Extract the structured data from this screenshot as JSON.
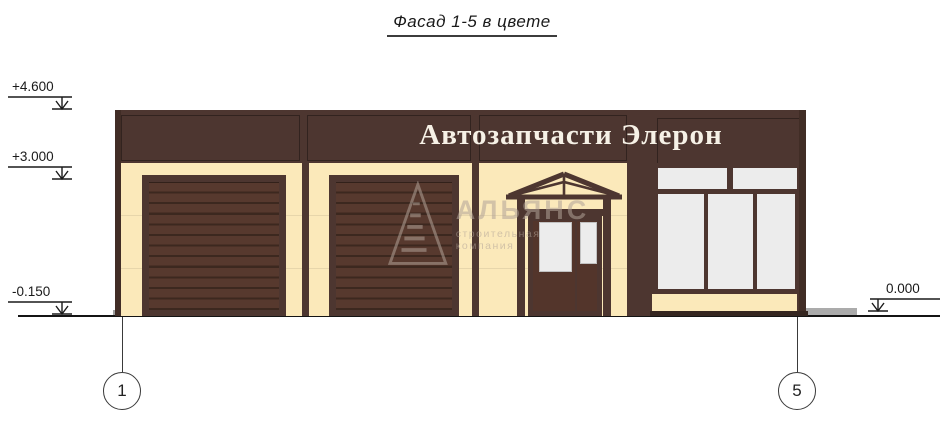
{
  "title": "Фасад 1-5 в цвете",
  "sign": "Автозапчасти Элерон",
  "elevation_marks": {
    "top": "+4.600",
    "middle": "+3.000",
    "bottom_left": "-0.150",
    "bottom_right": "0.000"
  },
  "grid_axes": {
    "left": "1",
    "right": "5"
  },
  "watermark": {
    "name": "АЛЬЯНС",
    "subtitle": "строительная компания",
    "logo_icon": "pyramid-logo-icon"
  },
  "colors": {
    "fascia_brown": "#4d3630",
    "edge_brown": "#412d26",
    "wall_cream": "#fbe9ba",
    "garage_door_brown": "#57392e",
    "garage_door_line": "#3c281f",
    "glass_gray": "#ececec",
    "pavement_dark": "#606060",
    "pavement_light": "#ababab",
    "ground_line": "#141414",
    "sign_text": "#f6f1e6"
  }
}
